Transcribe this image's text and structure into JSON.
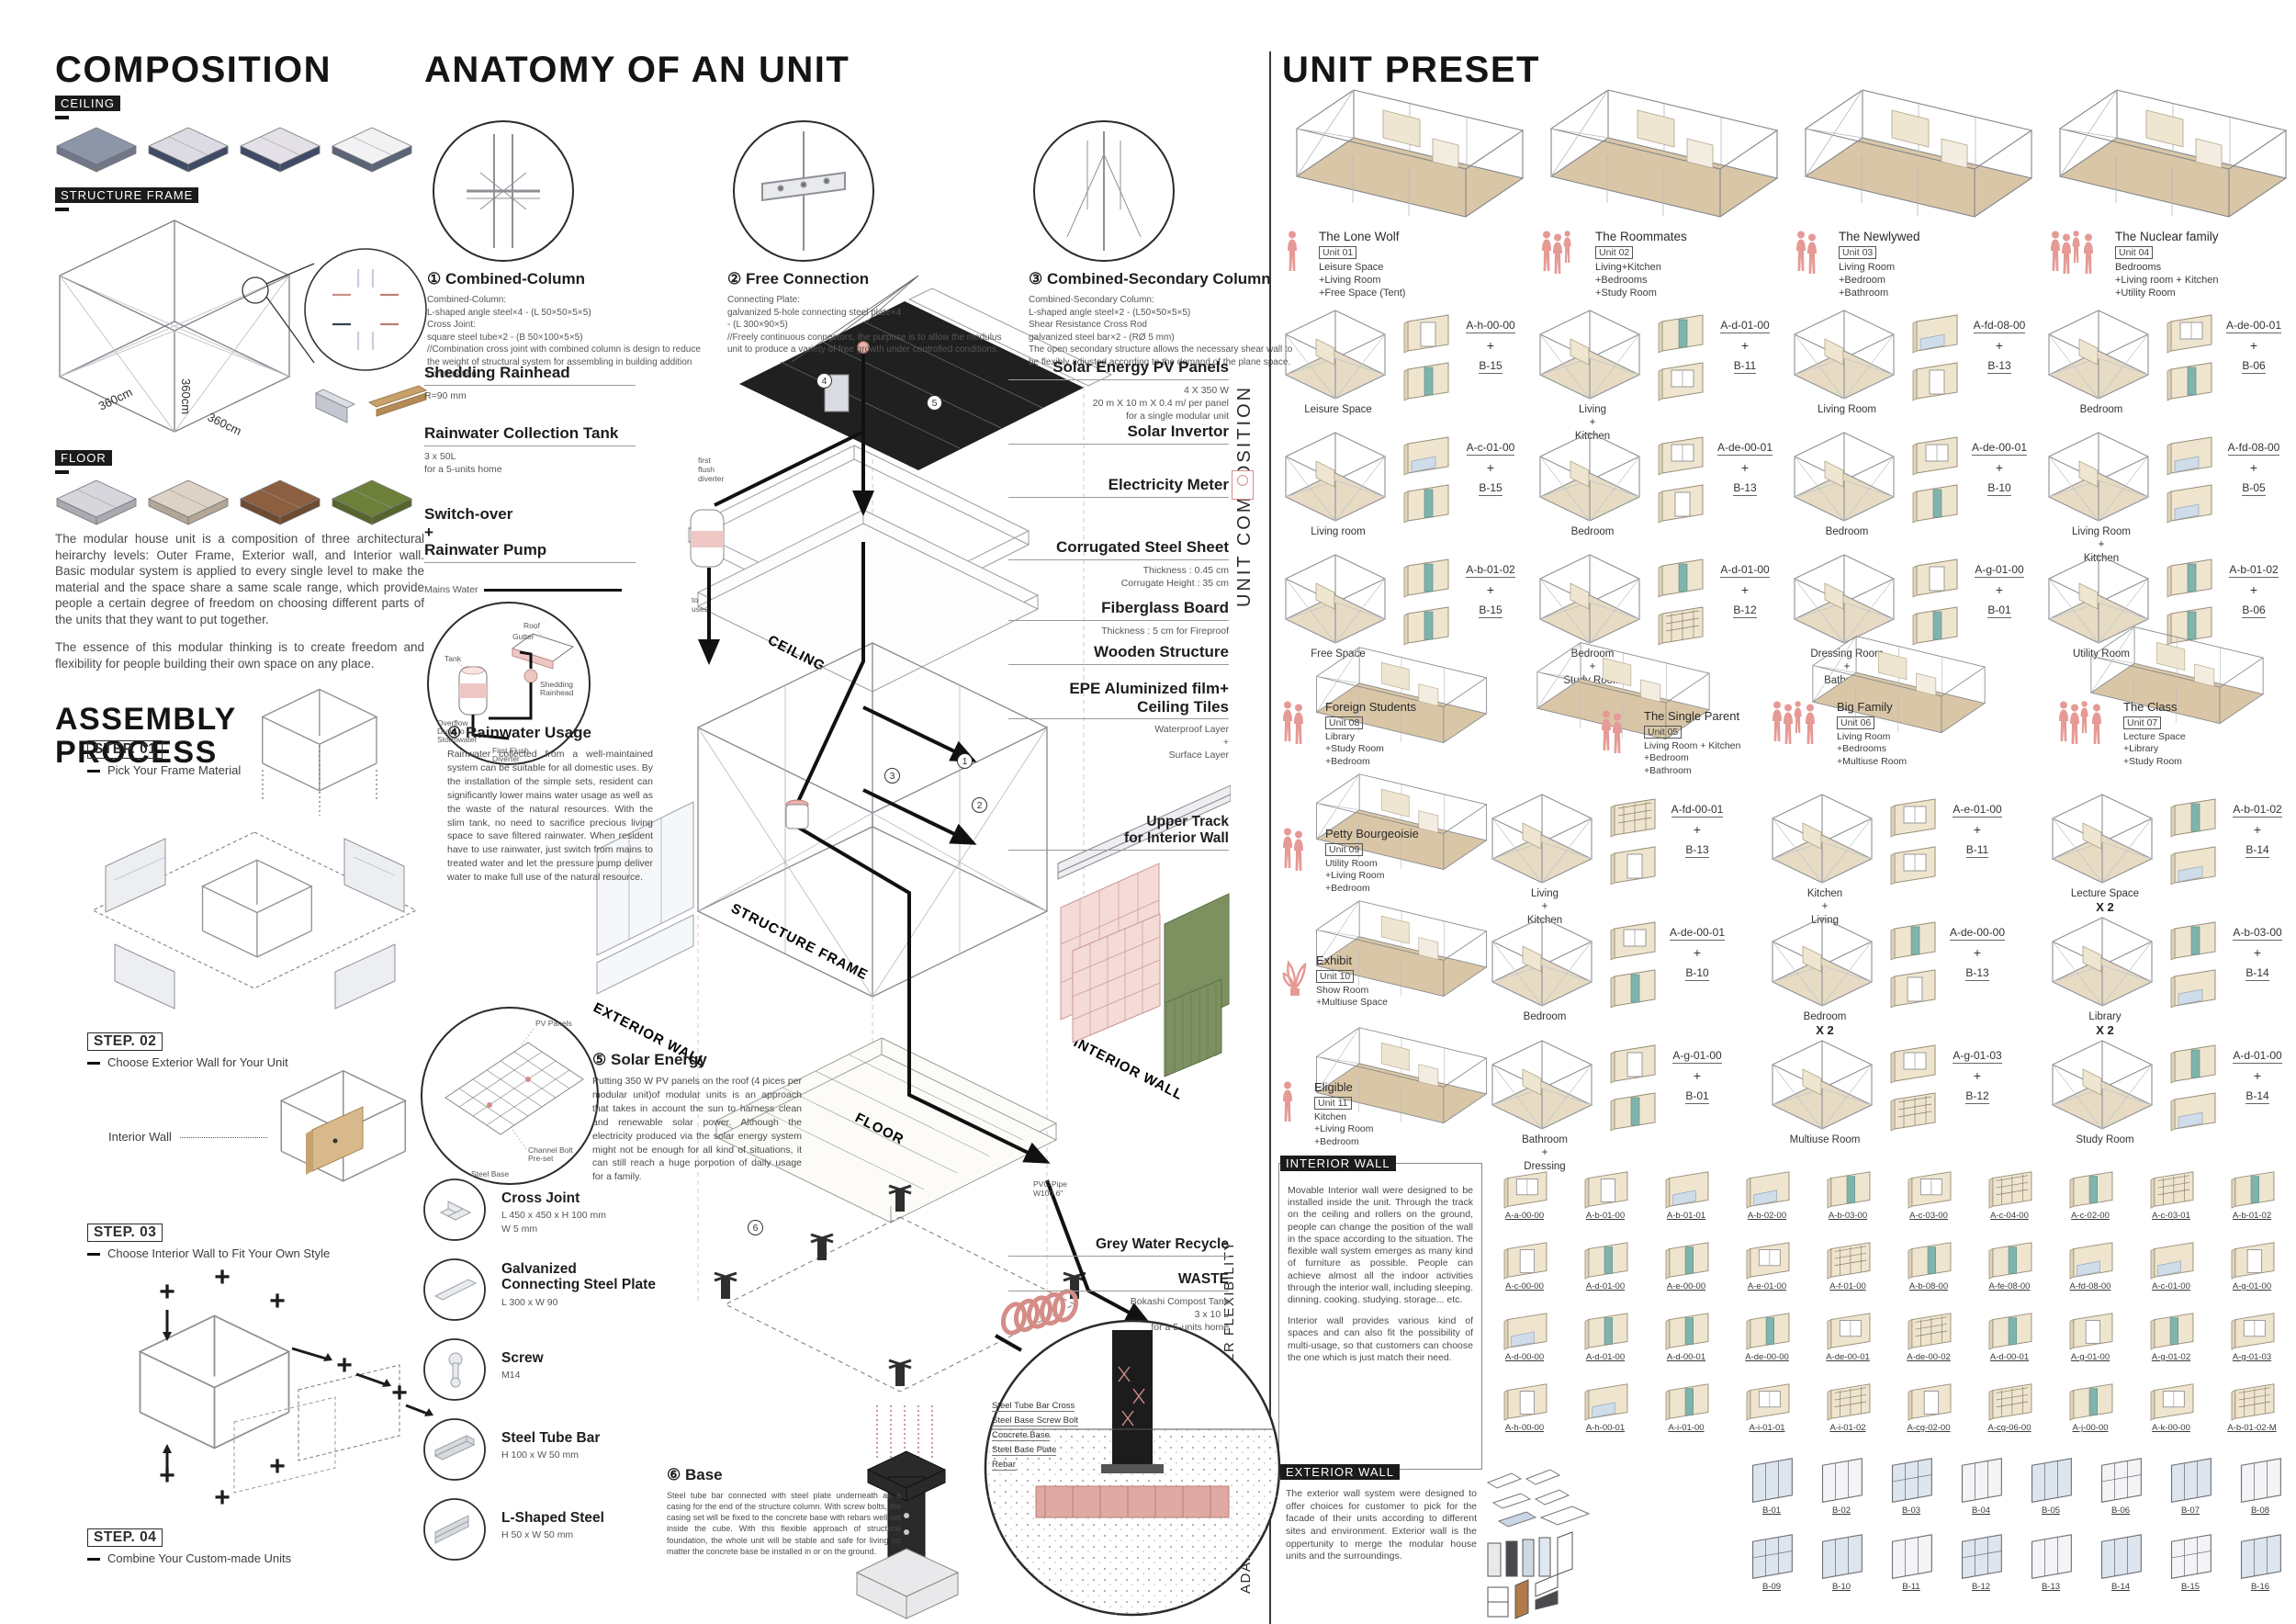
{
  "palette": {
    "pink": "#e59a95",
    "black": "#1b1b1b",
    "wood": "#c9a876",
    "grass": "#6d8039",
    "green_wall": "#7d9060",
    "teal": "#7fb3ab",
    "steel": "#b9bec7",
    "pv_dark": "#202020"
  },
  "composition": {
    "title": "COMPOSITION",
    "section_tags": [
      "CEILING",
      "STRUCTURE FRAME",
      "FLOOR"
    ],
    "frame_dims": [
      "360cm",
      "360cm",
      "360cm"
    ],
    "intro": [
      "The modular house unit is a composition of three architectural heirarchy levels: Outer Frame, Exterior wall, and Interior wall. Basic modular system is applied to every single level to make the material and the space share a same scale range, which provide people a certain degree of freedom on choosing different parts of the units that they want to put together.",
      "The essence of this modular thinking is to create freedom and flexibility for people building their own space on any place."
    ],
    "assembly": {
      "title": "ASSEMBLY\nPROCESS",
      "interior_wall_label": "Interior Wall",
      "steps": [
        {
          "tag": "STEP. 01",
          "caption": "Pick Your Frame Material"
        },
        {
          "tag": "STEP. 02",
          "caption": "Choose Exterior Wall for Your Unit"
        },
        {
          "tag": "STEP. 03",
          "caption": "Choose Interior Wall to Fit Your Own Style"
        },
        {
          "tag": "STEP. 04",
          "caption": "Combine Your Custom-made Units"
        }
      ]
    }
  },
  "anatomy": {
    "title": "ANATOMY OF AN UNIT",
    "details": [
      {
        "num": "①",
        "name": "Combined-Column",
        "spec": "Combined-Column:\nL-shaped angle steel×4 - (L 50×50×5×5)\nCross Joint:\nsquare steel tube×2 - (B 50×100×5×5)\n//Combination cross joint with combined column is design to reduce the weight of structural system for assembling in building addition construction."
      },
      {
        "num": "②",
        "name": "Free Connection",
        "spec": "Connecting Plate:\ngalvanized 5-hole connecting steel plate×4\n - (L 300×90×5)\n//Freely continuous connectors, the purpose is to allow the modulus unit to produce a variety of free growth under controlled conditions."
      },
      {
        "num": "③",
        "name": "Combined-Secondary Column",
        "spec": "Combined-Secondary Column:\nL-shaped angle steel×2 - (L50×50×5×5)\nShear Resistance Cross Rod\ngalvanized steel bar×2 - (RØ 5 mm)\nThe open secondary structure allows the necessary shear wall to be flexibly adjusted according to the demand of the plane space."
      }
    ],
    "left_labels": [
      {
        "title": "Shedding Rainhead",
        "sub": "R=90 mm"
      },
      {
        "title": "Rainwater Collection Tank",
        "sub": "3 x 50L\nfor a 5-units home"
      },
      {
        "title": "Switch-over\n+\nRainwater Pump",
        "sub": ""
      }
    ],
    "mains_water": "Mains Water",
    "first_flush": "first\nflush\ndiverter",
    "to_uses": "to\nuses",
    "rain_circle_labels": [
      "Roof",
      "Gutter",
      "Tank",
      "Overflow\nDrain to\nStormwater",
      "Shedding\nRainhead",
      "First Flush\nDiverter"
    ],
    "rainwater": {
      "num": "④",
      "name": "Rainwater Usage",
      "text": "Rainwater collected from a well-maintained system can be suitable for all domestic uses. By the installation of the simple sets, resident can significantly lower mains water usage as well as the waste of the natural resources. With the slim tank, no need to sacrifice precious living space to save filtered rainwater. When resident have to use rainwater, just switch from mains to treated water and let the pressure pump deliver water to make full use of the natural resource."
    },
    "solar": {
      "num": "⑤",
      "name": "Solar Energy",
      "text": "Putting 350 W PV panels on the roof (4 pices per modular unit)of modular units is an approach that takes in account the sun to harness clean and renewable solar power. Although the electricity produced via the solar energy system might not be enough for all kind of situations, it can still reach a huge porpotion of daily usage for a family.",
      "circle_labels": [
        "PV Panels",
        "Channel Bolt\nPre-set",
        "Steel Base"
      ]
    },
    "right_labels": [
      {
        "title": "Solar Energy PV Panels",
        "sub": "4 X 350 W\n20 m X 10 m X 0.4 m/ per panel\nfor a single modular unit"
      },
      {
        "title": "Solar Invertor",
        "sub": ""
      },
      {
        "title": "Electricity Meter",
        "sub": ""
      },
      {
        "title": "Corrugated Steel Sheet",
        "sub": "Thickness : 0.45 cm\nCorrugate Height : 35 cm"
      },
      {
        "title": "Fiberglass Board",
        "sub": "Thickness : 5 cm for Fireproof"
      },
      {
        "title": "Wooden Structure",
        "sub": ""
      },
      {
        "title": "EPE Aluminized film+\nCeiling Tiles",
        "sub": "Waterproof Layer\n+\nSurface Layer"
      }
    ],
    "upper_track": "Upper Track\nfor Interior Wall",
    "pvc": "PVC Pipe\nW100  6\"",
    "grey_water": "Grey Water Recycle",
    "waste": {
      "title": "WASTE",
      "sub": "Bokashi Compost Tank\n3 x 10 L\nfor a 5-units home"
    },
    "layer_labels": [
      "CEILING",
      "STRUCTURE FRAME",
      "EXTERIOR WALL",
      "FLOOR",
      "INTERIOR WALL"
    ],
    "parts": [
      {
        "name": "Cross Joint",
        "spec": "L 450 x 450 x H 100 mm\nW 5 mm"
      },
      {
        "name": "Galvanized\nConnecting Steel Plate",
        "spec": "L 300 x W 90"
      },
      {
        "name": "Screw",
        "spec": "M14"
      },
      {
        "name": "Steel Tube Bar",
        "spec": "H 100 x W 50 mm"
      },
      {
        "name": "L-Shaped Steel",
        "spec": "H 50 x W 50 mm"
      }
    ],
    "base": {
      "num": "⑥",
      "name": "Base",
      "text": "Steel tube bar connected with steel plate underneath as a casing for the end of the structure column. With screw bolts, the casing set will be fixed to the concrete base with rebars well set inside the cube. With this flexible approach of structural foundation, the whole unit will be stable and safe for living no matter the concrete base be installed in or on the ground.",
      "labels": [
        "Steel Tube Bar Cross",
        "Steel Base Screw Bolt",
        "Concrete Base",
        "Steel Base Plate",
        "Rebar"
      ]
    }
  },
  "preset": {
    "title": "UNIT PRESET",
    "side_labels": {
      "composition": "UNIT COMPOSITION",
      "flexibility": "INNER\nFLEXIBILITY",
      "adaptation": "OUTER\nADAPTATION"
    },
    "units_top": [
      {
        "name": "The Lone Wolf",
        "tag": "Unit 01",
        "rooms": "Leisure Space\n+Living Room\n+Free Space (Tent)",
        "figures": 1
      },
      {
        "name": "The Roommates",
        "tag": "Unit 02",
        "rooms": "Living+Kitchen\n+Bedrooms\n+Study Room",
        "figures": 3
      },
      {
        "name": "The Newlywed",
        "tag": "Unit 03",
        "rooms": "Living Room\n+Bedroom\n+Bathroom",
        "figures": 2
      },
      {
        "name": "The Nuclear family",
        "tag": "Unit 04",
        "rooms": "Bedrooms\n+Living room + Kitchen\n+Utility Room",
        "figures": 4
      }
    ],
    "comp_grid_top": [
      [
        {
          "room": "Leisure Space",
          "a": "A-h-00-00",
          "b": "B-15"
        },
        {
          "room": "Living\n+\nKitchen",
          "a": "A-d-01-00",
          "b": "B-11"
        },
        {
          "room": "Living Room",
          "a": "A-fd-08-00",
          "b": "B-13"
        },
        {
          "room": "Bedroom",
          "a": "A-de-00-01",
          "b": "B-06"
        }
      ],
      [
        {
          "room": "Living room",
          "a": "A-c-01-00",
          "b": "B-15"
        },
        {
          "room": "Bedroom",
          "a": "A-de-00-01",
          "b": "B-13"
        },
        {
          "room": "Bedroom",
          "a": "A-de-00-01",
          "b": "B-10"
        },
        {
          "room": "Living Room\n+\nKitchen",
          "a": "A-fd-08-00",
          "b": "B-05"
        }
      ],
      [
        {
          "room": "Free Space",
          "a": "A-b-01-02",
          "b": "B-15"
        },
        {
          "room": "Bedroom\n+\nStudy Room",
          "a": "A-d-01-00",
          "b": "B-12"
        },
        {
          "room": "Dressing Room\n+\nBathroom",
          "a": "A-g-01-00",
          "b": "B-01"
        },
        {
          "room": "Utility Room",
          "a": "A-b-01-02",
          "b": "B-06"
        }
      ]
    ],
    "units_mid_left": [
      {
        "name": "Foreign Students",
        "tag": "Unit 08",
        "rooms": "Library\n+Study Room\n+Bedroom",
        "figures": 2
      },
      {
        "name": "Petty Bourgeoisie",
        "tag": "Unit 09",
        "rooms": "Utility Room\n+Living Room\n+Bedroom",
        "figures": 2
      },
      {
        "name": "Exhibit",
        "tag": "Unit 10",
        "rooms": "Show Room\n+Multiuse Space",
        "figures": 0,
        "plant": true
      },
      {
        "name": "Eligible",
        "tag": "Unit 11",
        "rooms": "Kitchen\n+Living Room\n+Bedroom",
        "figures": 1
      }
    ],
    "units_mid": [
      {
        "name": "The Single Parent",
        "tag": "Unit 05",
        "rooms": "Living Room + Kitchen\n+Bedroom\n+Bathroom",
        "figures": 2
      },
      {
        "name": "Big Family",
        "tag": "Unit 06",
        "rooms": "Living Room\n+Bedrooms\n+Multiuse Room",
        "figures": 4
      },
      {
        "name": "The Class",
        "tag": "Unit 07",
        "rooms": "Lecture Space\n+Library\n+Study Room",
        "figures": 4
      }
    ],
    "comp_grid_mid": [
      [
        {
          "room": "Living\n+\nKitchen",
          "a": "A-fd-00-01",
          "b": "B-13"
        },
        {
          "room": "Kitchen\n+\nLiving",
          "a": "A-e-01-00",
          "b": "B-11"
        },
        {
          "room": "Lecture Space",
          "note": "X 2",
          "a": "A-b-01-02",
          "b": "B-14"
        }
      ],
      [
        {
          "room": "Bedroom",
          "a": "A-de-00-01",
          "b": "B-10"
        },
        {
          "room": "Bedroom",
          "note": "X 2",
          "a": "A-de-00-00",
          "b": "B-13"
        },
        {
          "room": "Library",
          "note": "X 2",
          "a": "A-b-03-00",
          "b": "B-14"
        }
      ],
      [
        {
          "room": "Bathroom\n+\nDressing",
          "a": "A-g-01-00",
          "b": "B-01"
        },
        {
          "room": "Multiuse Room",
          "a": "A-g-01-03",
          "b": "B-12"
        },
        {
          "room": "Study Room",
          "a": "A-d-01-00",
          "b": "B-14"
        }
      ]
    ],
    "interior": {
      "tag": "INTERIOR WALL",
      "text1": "Movable Interior wall were designed to be installed inside the unit. Through the track on the ceiling and rollers on the ground, people can change the position of the wall in the space according to the situation. The flexible wall system emerges as many kind of furniture as possible. People can achieve almost all the indoor activities through the interior wall, including sleeping. dinning. cooking. studying. storage... etc.",
      "text2": "Interior wall provides various kind of spaces and can also fit the possibility of multi-usage, so that customers can choose the one which is just match their need.",
      "codes": [
        [
          "A-a-00-00",
          "A-b-01-00",
          "A-b-01-01",
          "A-b-02-00",
          "A-b-03-00",
          "A-c-03-00",
          "A-c-04-00",
          "A-c-02-00",
          "A-c-03-01",
          "A-b-01-02"
        ],
        [
          "A-c-00-00",
          "A-d-01-00",
          "A-e-00-00",
          "A-e-01-00",
          "A-f-01-00",
          "A-b-08-00",
          "A-fe-08-00",
          "A-fd-08-00",
          "A-c-01-00",
          "A-g-01-00"
        ],
        [
          "A-d-00-00",
          "A-d-01-00",
          "A-d-00-01",
          "A-de-00-00",
          "A-de-00-01",
          "A-de-00-02",
          "A-d-00-01",
          "A-g-01-00",
          "A-g-01-02",
          "A-g-01-03"
        ],
        [
          "A-h-00-00",
          "A-h-00-01",
          "A-i-01-00",
          "A-i-01-01",
          "A-i-01-02",
          "A-cg-02-00",
          "A-cg-06-00",
          "A-j-00-00",
          "A-k-00-00",
          "A-b-01-02-M"
        ]
      ]
    },
    "exterior": {
      "tag": "EXTERIOR WALL",
      "text": "The exterior wall system were designed to offer choices for customer to pick for the facade of their units according to different sites and environment. Exterior wall is the oppertunity to merge the modular house units and the surroundings.",
      "codes": [
        [
          "B-01",
          "B-02",
          "B-03",
          "B-04",
          "B-05",
          "B-06",
          "B-07",
          "B-08"
        ],
        [
          "B-09",
          "B-10",
          "B-11",
          "B-12",
          "B-13",
          "B-14",
          "B-15",
          "B-16"
        ]
      ]
    }
  }
}
